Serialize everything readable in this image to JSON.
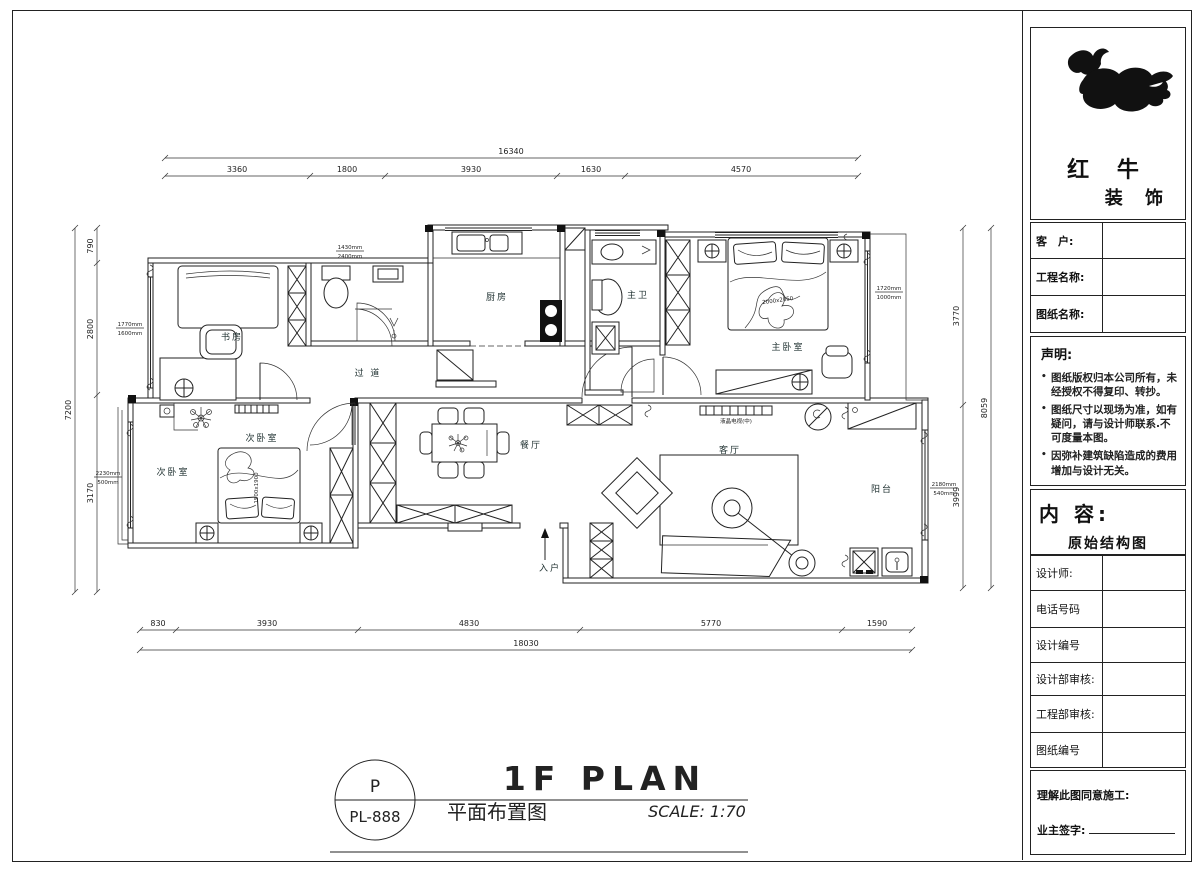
{
  "company": {
    "name_top": "红 牛",
    "name_bottom": "装 饰"
  },
  "title_block": {
    "client_label": "客　户:",
    "project_label": "工程名称:",
    "drawing_label": "图纸名称:",
    "statement_title": "声明:",
    "statement_items": [
      "图纸版权归本公司所有，未经授权不得复印、转抄。",
      "图纸尺寸以现场为准，如有疑问，请与设计师联系.不可度量本图。",
      "因弥补建筑缺陷造成的费用增加与设计无关。"
    ],
    "content_label": "内 容:",
    "content_value": "原始结构图",
    "designer_label": "设计师:",
    "phone_label": "电话号码",
    "design_no_label": "设计编号",
    "design_audit_label": "设计部审核:",
    "engineering_audit_label": "工程部审核:",
    "drawing_no_label": "图纸编号",
    "footer_line1": "理解此图同意施工:",
    "footer_line2": "业主签字:"
  },
  "title_bar": {
    "stamp_top": "P",
    "stamp_bottom": "PL-888",
    "title_en": "1F PLAN",
    "title_cn": "平面布置图",
    "scale": "SCALE: 1:70"
  },
  "rooms": {
    "study": "书房",
    "kitchen": "厨房",
    "master_bath": "主卫",
    "master_bed": "主卧室",
    "corridor": "过 道",
    "bed2a": "次卧室",
    "bed2b": "次卧室",
    "dining": "餐厅",
    "living": "客厅",
    "balcony": "阳台",
    "entry": "入户"
  },
  "furniture": {
    "master_bed_size": "2000x2050",
    "second_bed_size": "1500x1900",
    "tv_label": "液晶电视(中)"
  },
  "window_tags": {
    "kitchen_top": {
      "w": "1430mm",
      "h": "2400mm"
    },
    "study_left": {
      "w": "1770mm",
      "h": "1600mm"
    },
    "bed2_left": {
      "w": "2230mm",
      "h": "500mm"
    },
    "master_right": {
      "w": "1720mm",
      "h": "1000mm"
    },
    "balcony_right": {
      "w": "2180mm",
      "h": "540mm"
    }
  },
  "dims": {
    "top": {
      "total": "16340",
      "segments": [
        "3360",
        "1800",
        "3930",
        "1630",
        "4570"
      ]
    },
    "bottom": {
      "total": "18030",
      "segments": [
        "830",
        "3930",
        "4830",
        "5770",
        "1590"
      ]
    },
    "left": {
      "total": "7200",
      "segments": [
        "790",
        "2800",
        "3170"
      ]
    },
    "right": {
      "total": "8059",
      "segments": [
        "3770",
        "3999"
      ]
    }
  }
}
